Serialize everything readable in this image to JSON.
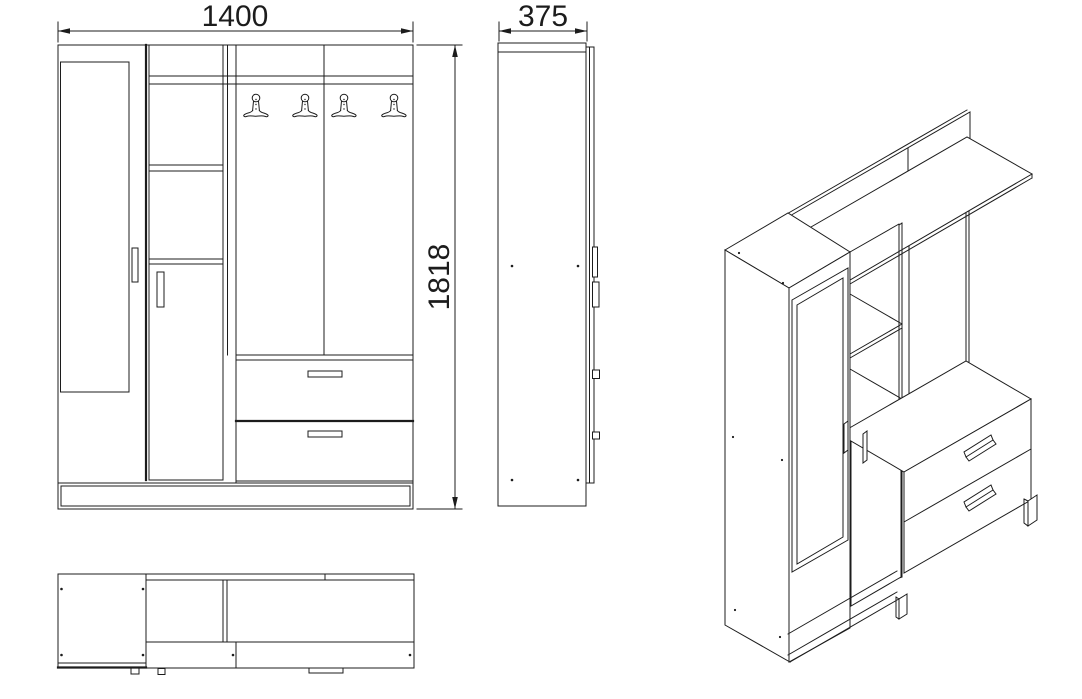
{
  "colors": {
    "background": "#ffffff",
    "line": "#1c1c1c"
  },
  "dimensions": {
    "width_label": "1400",
    "depth_label": "375",
    "height_label": "1818"
  },
  "features": {
    "coat_hooks": 4,
    "drawers": 2,
    "doors": 2,
    "mirror_doors": 1
  }
}
